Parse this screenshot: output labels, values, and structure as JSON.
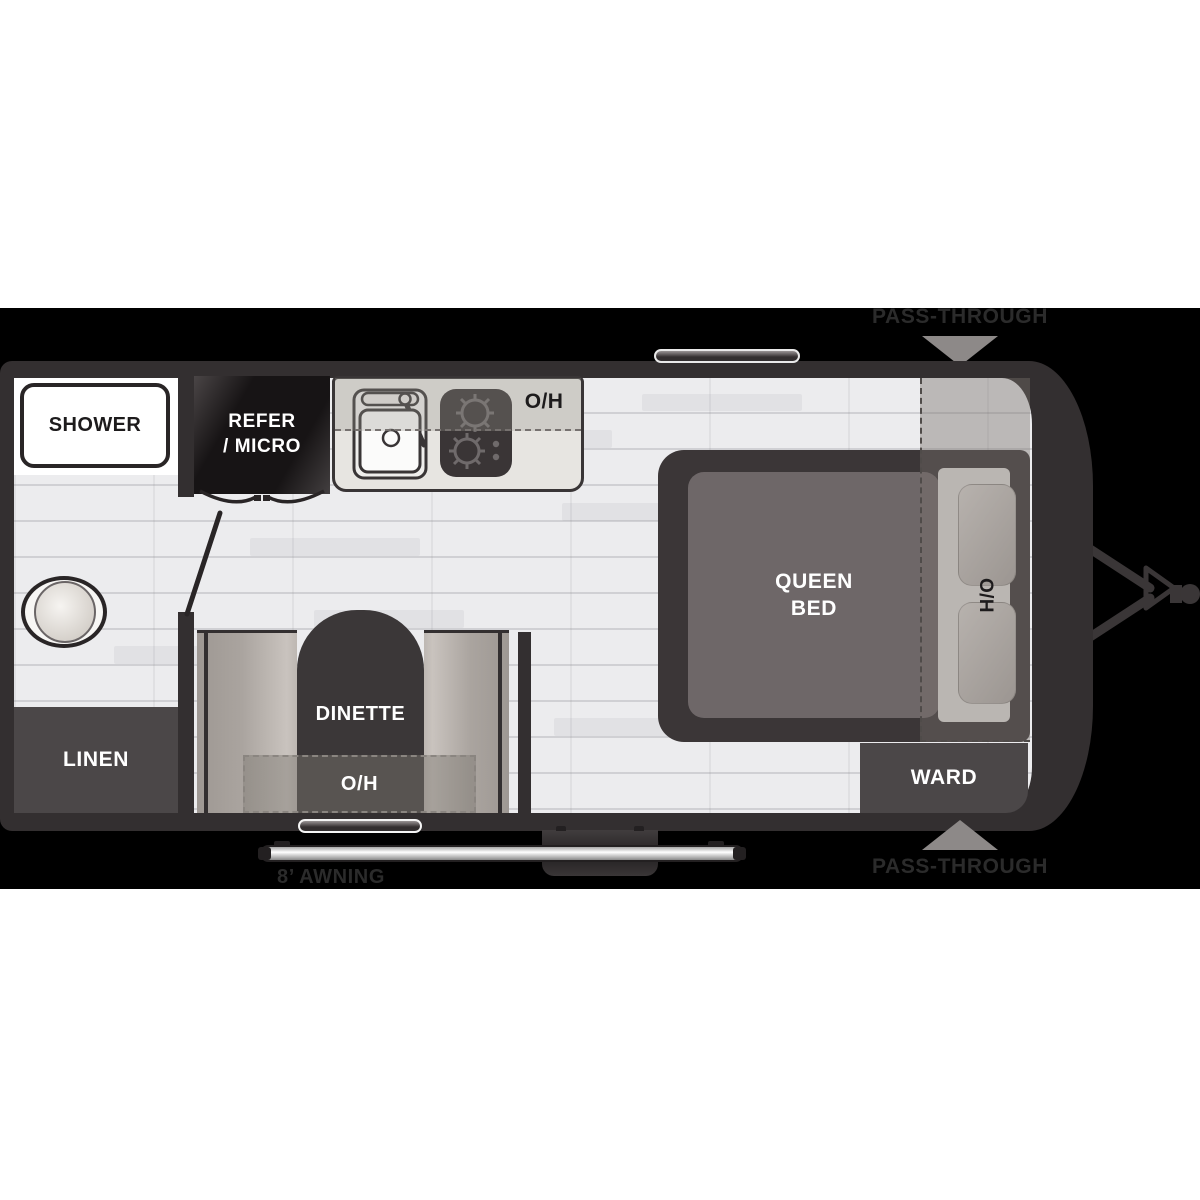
{
  "title": "Travel trailer floor plan",
  "exterior": {
    "pass_through_top": "PASS-THROUGH",
    "pass_through_bottom": "PASS-THROUGH",
    "awning": "8’ AWNING"
  },
  "interior": {
    "shower": "SHOWER",
    "refer_micro": {
      "line1": "REFER",
      "line2": "/ MICRO"
    },
    "kitchen_overhead": "O/H",
    "bed": {
      "line1": "QUEEN",
      "line2": "BED",
      "headboard_overhead": "H/O"
    },
    "ward": "WARD",
    "linen": "LINEN",
    "dinette": {
      "label": "DINETTE",
      "overhead": "O/H"
    }
  },
  "colors": {
    "background_band": "#000000",
    "wall": "#332f30",
    "floor": "#ececee",
    "cabinet_dark": "#4b4748",
    "bench": "#b5afaa",
    "arrow_gray": "#8d8988",
    "outside_label": "#2b2b2b",
    "pass_through_shade": "rgba(118,112,107,0.42)"
  }
}
